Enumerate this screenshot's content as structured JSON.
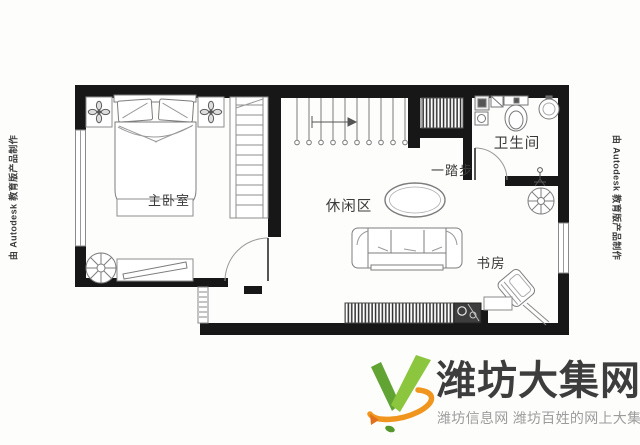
{
  "watermark": {
    "autodesk_left": "由 Autodesk 教育版产品制作",
    "autodesk_right": "由 Autodesk 教育版产品制作"
  },
  "floorplan": {
    "rooms": {
      "master_bedroom": "主卧室",
      "leisure_area": "休闲区",
      "bathroom": "卫生间",
      "study": "书房"
    },
    "annotations": {
      "one_step": "一踏步"
    }
  },
  "logo": {
    "site_name": "潍坊大集网",
    "tagline": "潍坊信息网 潍坊百姓的网上大集",
    "colors": {
      "green_dark": "#61a434",
      "green_light": "#8cc63e",
      "orange": "#f0961e",
      "title": "#3d3d3d",
      "tagline_gray": "#9c9c9c"
    }
  },
  "icons": {
    "logo_mark": "green-v-with-orange-orbit-swoosh",
    "plant": "fan-bladed-plant-top-view",
    "lamp": "four-petal-lamp",
    "stairs": "straight-run-stairs-with-up-arrow"
  }
}
